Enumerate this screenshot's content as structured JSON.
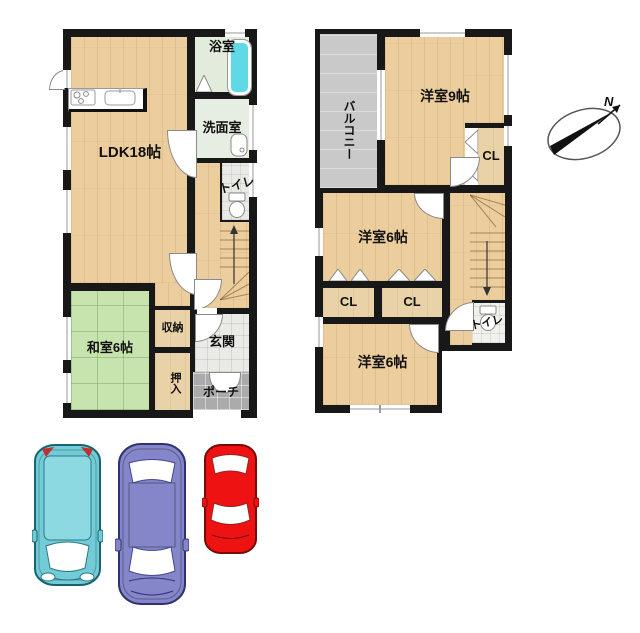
{
  "floor1": {
    "rooms": {
      "ldk": "LDK18帖",
      "bath": "浴室",
      "washroom": "洗面室",
      "toilet": "トイレ",
      "washitsu": "和室6帖",
      "storage": "収納",
      "genkan": "玄関",
      "oshiire": "押入",
      "porch": "ポーチ"
    }
  },
  "floor2": {
    "rooms": {
      "balcony": "バルコニー",
      "bedroom9": "洋室9帖",
      "closet_top": "CL",
      "bedroom6_mid": "洋室6帖",
      "closet_left": "CL",
      "closet_right": "CL",
      "bedroom6_bottom": "洋室6帖",
      "toilet": "トイレ"
    }
  },
  "compass": {
    "north_label": "N"
  },
  "colors": {
    "wall": "#181818",
    "wood_floor": "#EBCD9E",
    "closet_floor": "#E9D2A8",
    "tatami": "#C7E3AE",
    "bath_floor": "#E2EBDC",
    "genkan_tile": "#EAEAE6",
    "porch_tile": "#ABABAB",
    "balcony": "#C9C9C9",
    "bathtub": "#5FD9E6"
  },
  "cars": [
    {
      "name": "teal-hatchback",
      "color": "#72CBD6",
      "roof": "#8CD9E2"
    },
    {
      "name": "purple-sedan",
      "color": "#8486C9",
      "roof": "#8486C9"
    },
    {
      "name": "red-compact",
      "color": "#EE1212",
      "roof": "#EE1212"
    }
  ]
}
